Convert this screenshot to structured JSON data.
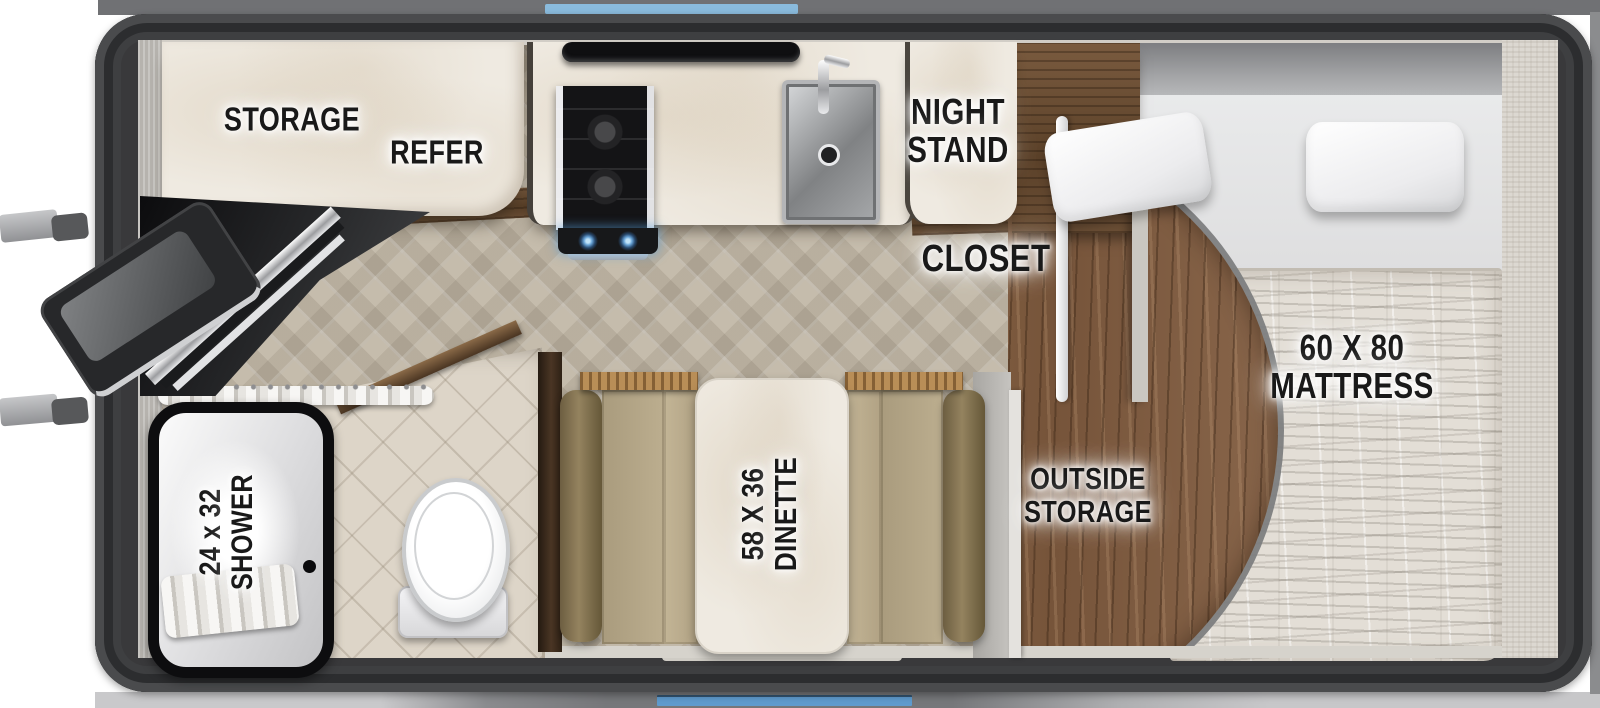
{
  "floorplan": {
    "labels": {
      "storage": "STORAGE",
      "refer": "REFER",
      "night_stand": [
        "NIGHT",
        "STAND"
      ],
      "closet": "CLOSET",
      "mattress": [
        "60 X 80",
        "MATTRESS"
      ],
      "outside_storage": [
        "OUTSIDE",
        "STORAGE"
      ],
      "dinette": [
        "58 X 36",
        "DINETTE"
      ],
      "shower": [
        "24 x 32",
        "SHOWER"
      ]
    },
    "colors": {
      "accent_blue_top": "#8abbdd",
      "accent_blue_bottom": "#5f9bce",
      "body_frame": "#39393b",
      "wood_floor": "#82613f",
      "cushion_tan": "#b3a585",
      "label_text": "#191919"
    }
  }
}
